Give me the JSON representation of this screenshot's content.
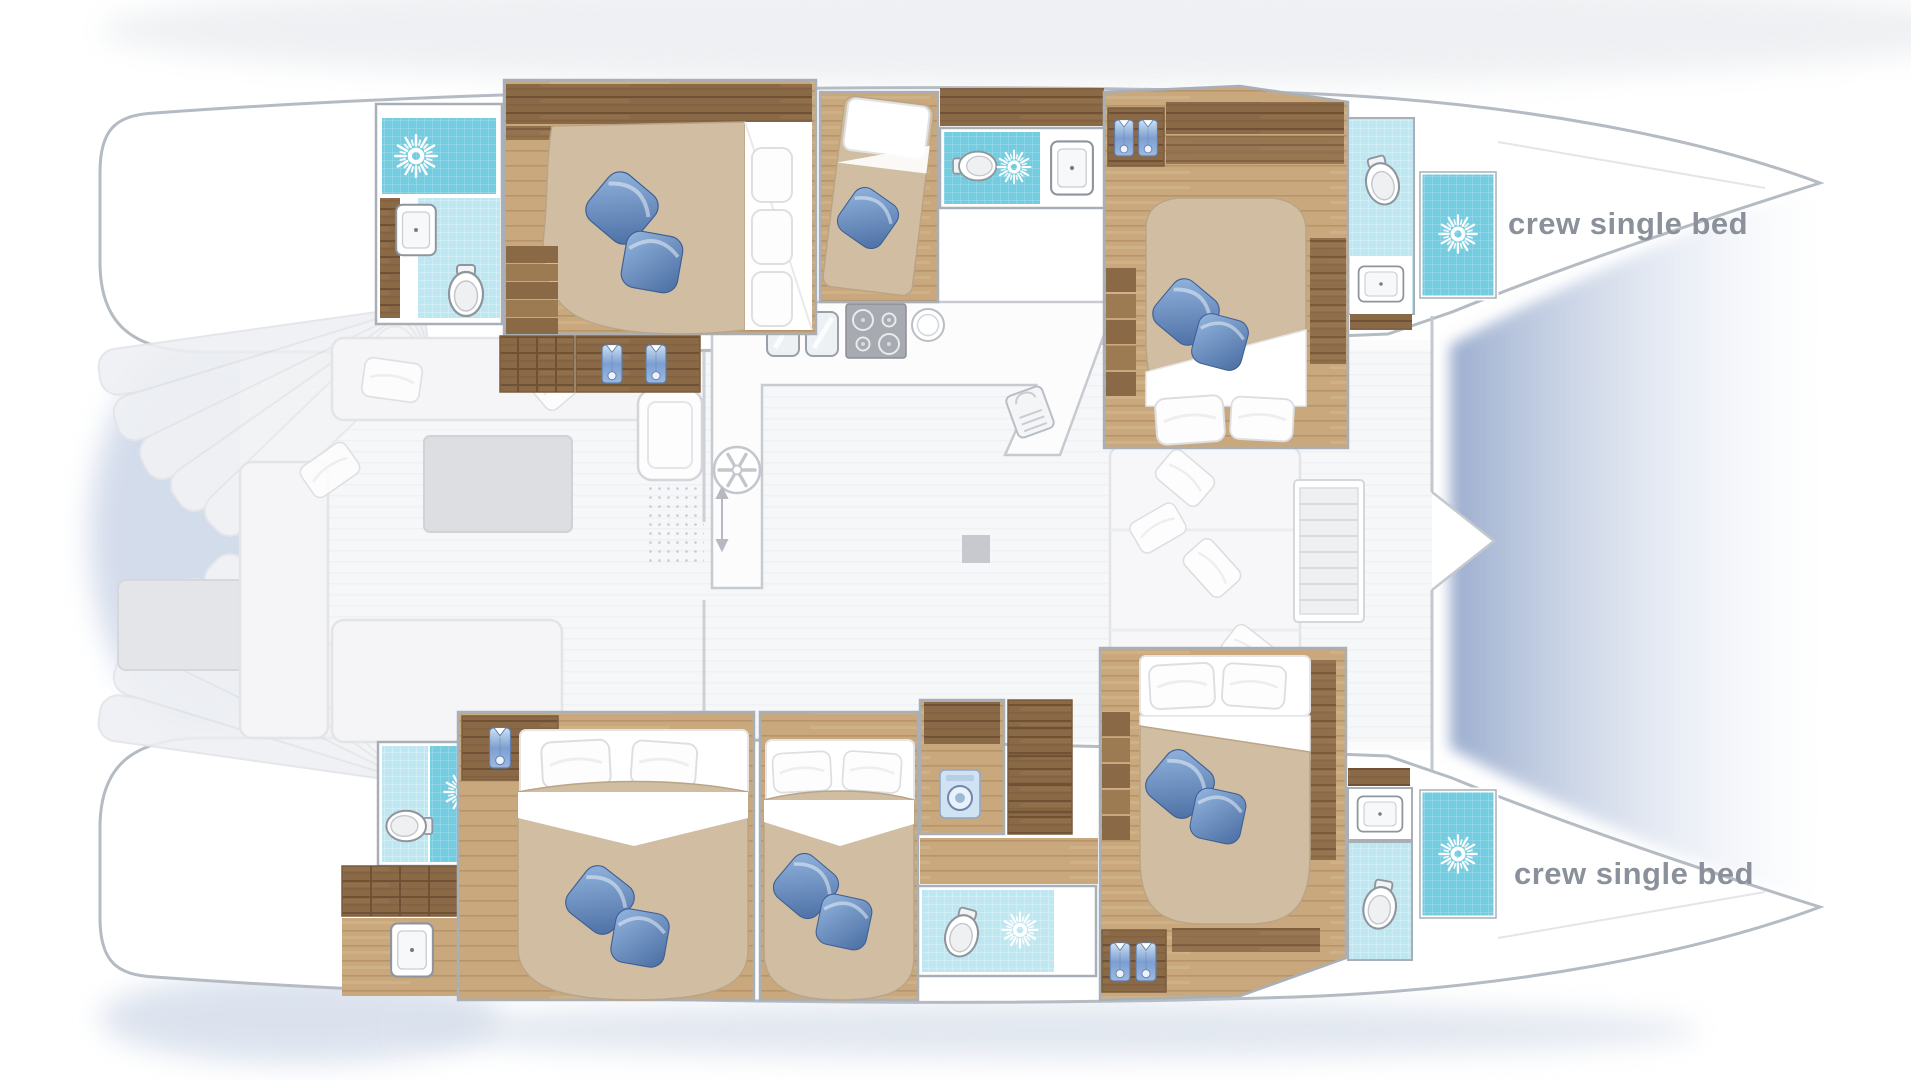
{
  "labels": {
    "crew_single_bed": "crew single bed"
  },
  "colors": {
    "hull_stroke": "#b5bbc3",
    "wood_dark": "#8a6947",
    "wood_light": "#c9a87e",
    "tile_light": "#bfe7f1",
    "tile_dark": "#74cce1",
    "bed_duvet": "#d0bda2",
    "bed_duvet_edge": "#b9a585",
    "label": "#8b919b",
    "room_stroke": "#a9afb7",
    "fixture_stroke": "#8e959d",
    "faded_fill": "#f5f5f7",
    "faded_stroke": "#e2e4e8"
  },
  "icons": {
    "shower": "sun-burst-shower-icon",
    "toilet": "toilet-icon",
    "sink": "sink-basin-icon",
    "galley_sink": "double-sink-icon",
    "stove": "four-burner-stove-icon",
    "round_sink": "round-sink-icon",
    "counter_sink": "counter-sink-faucet-icon",
    "fan": "vent-fan-icon",
    "washing_machine": "washing-machine-icon",
    "wardrobe": "hanging-shirt-icon",
    "pillow_blue": "blue-pillow-icon",
    "pillow_white": "white-pillow-icon"
  }
}
